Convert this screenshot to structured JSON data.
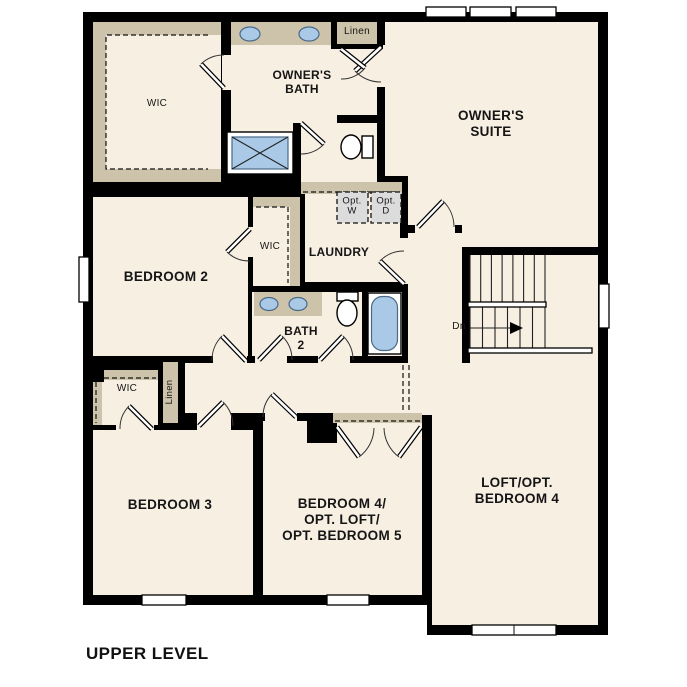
{
  "title": {
    "upper_level": "UPPER LEVEL"
  },
  "colors": {
    "floor": "#f7efe2",
    "closet": "#cdc3ab",
    "wall": "#000000",
    "fixture_blue": "#a9c9e7",
    "appliance_gray": "#dcdcdc"
  },
  "rooms": {
    "owners_wic": "WIC",
    "owners_bath": "OWNER'S\nBATH",
    "linen_upper": "Linen",
    "owners_suite": "OWNER'S\nSUITE",
    "bedroom2": "BEDROOM 2",
    "bedroom2_wic": "WIC",
    "laundry": "LAUNDRY",
    "opt_washer": "Opt.\nW",
    "opt_dryer": "Opt.\nD",
    "bath2": "BATH\n2",
    "stairs_down": "Dn",
    "bedroom3_wic": "WIC",
    "hall_linen": "Linen",
    "bedroom3": "BEDROOM 3",
    "bedroom4": "BEDROOM 4/\nOPT. LOFT/\nOPT. BEDROOM 5",
    "loft": "LOFT/OPT.\nBEDROOM 4"
  }
}
